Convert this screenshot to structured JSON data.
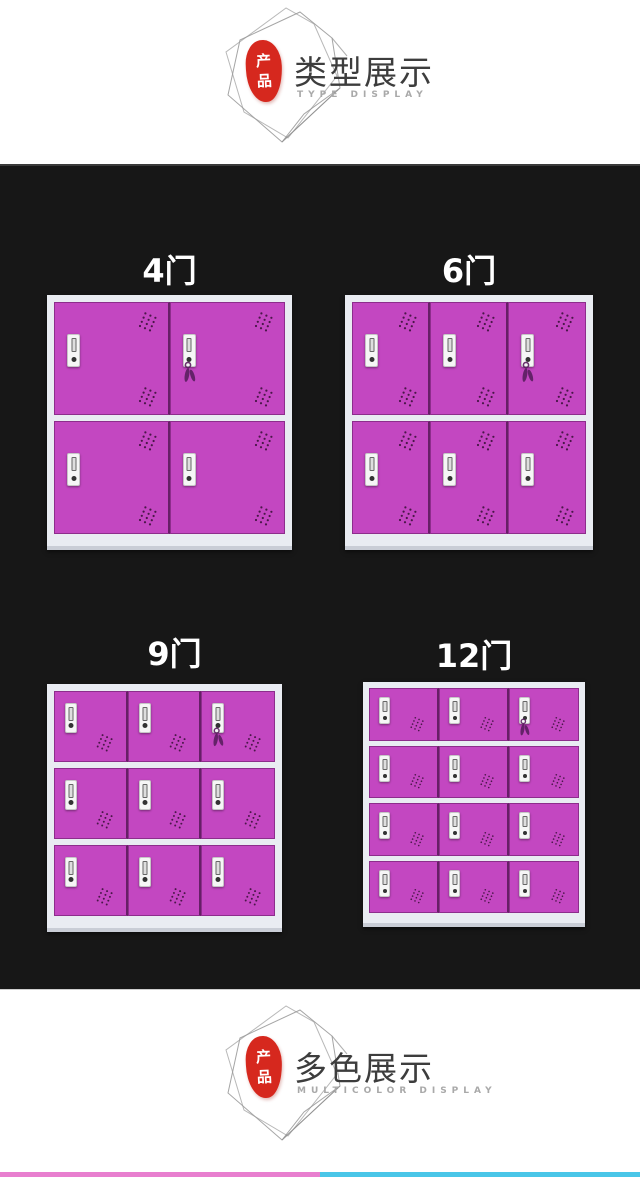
{
  "colors": {
    "door": "#c347c1",
    "frame": "#e9ecf2",
    "base": "#c9cdd6",
    "section_bg": "#171717",
    "seal_red": "#d6281e",
    "vent_dots": "#2b0a29",
    "keys": "#5a1e60",
    "bar_pink": "#e87fcf",
    "bar_cyan": "#49c6e8",
    "title_text": "#3d3d3d",
    "subtitle_text": "#a9a9a9",
    "label_text": "#ffffff"
  },
  "header": {
    "seal_top": "产",
    "seal_bottom": "品",
    "title": "类型展示",
    "subtitle": "TYPE DISPLAY"
  },
  "footer": {
    "seal_top": "产",
    "seal_bottom": "品",
    "title": "多色展示",
    "subtitle": "MULTICOLOR DISPLAY"
  },
  "lockers": [
    {
      "label": "4门",
      "rows": 2,
      "cols": 2,
      "vents": "double",
      "keys_door": 1
    },
    {
      "label": "6门",
      "rows": 2,
      "cols": 3,
      "vents": "double",
      "keys_door": 2
    },
    {
      "label": "9门",
      "rows": 3,
      "cols": 3,
      "vents": "bottom",
      "keys_door": 2
    },
    {
      "label": "12门",
      "rows": 4,
      "cols": 3,
      "vents": "bottom",
      "keys_door": 2
    }
  ]
}
